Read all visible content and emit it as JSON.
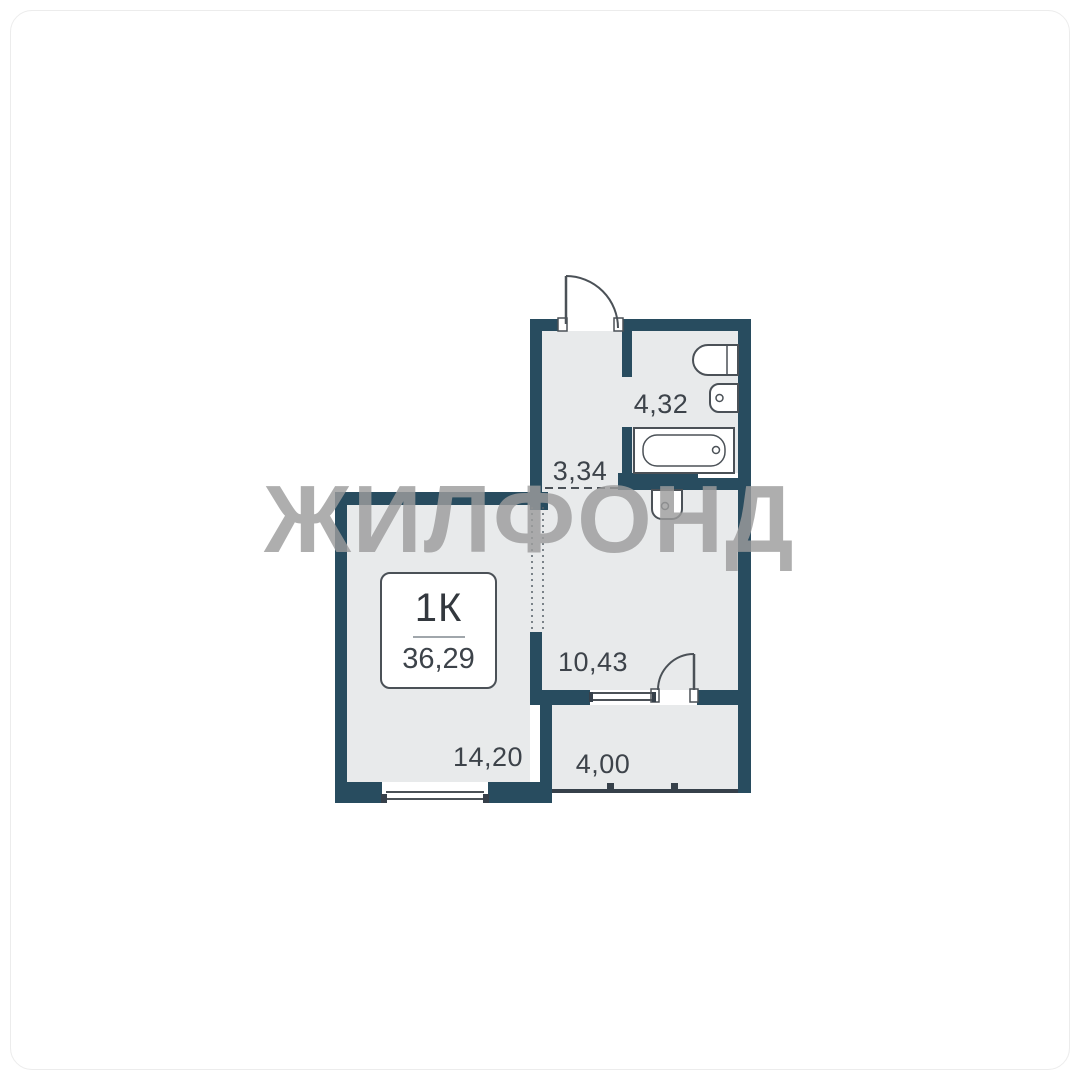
{
  "watermark": {
    "text": "ЖИЛФОНД"
  },
  "unit_card": {
    "type": "1К",
    "total_area": "36,29"
  },
  "rooms": [
    {
      "id": "bathroom",
      "area": "4,32"
    },
    {
      "id": "hallway",
      "area": "3,34"
    },
    {
      "id": "kitchen",
      "area": "10,43"
    },
    {
      "id": "living-room",
      "area": "14,20"
    },
    {
      "id": "balcony",
      "area": "4,00"
    }
  ],
  "colors": {
    "wall": "#284c5f",
    "floor": "#e8eaeb",
    "line": "#4b5157",
    "text": "#3d434a",
    "watermark": "#9d9d9d"
  }
}
